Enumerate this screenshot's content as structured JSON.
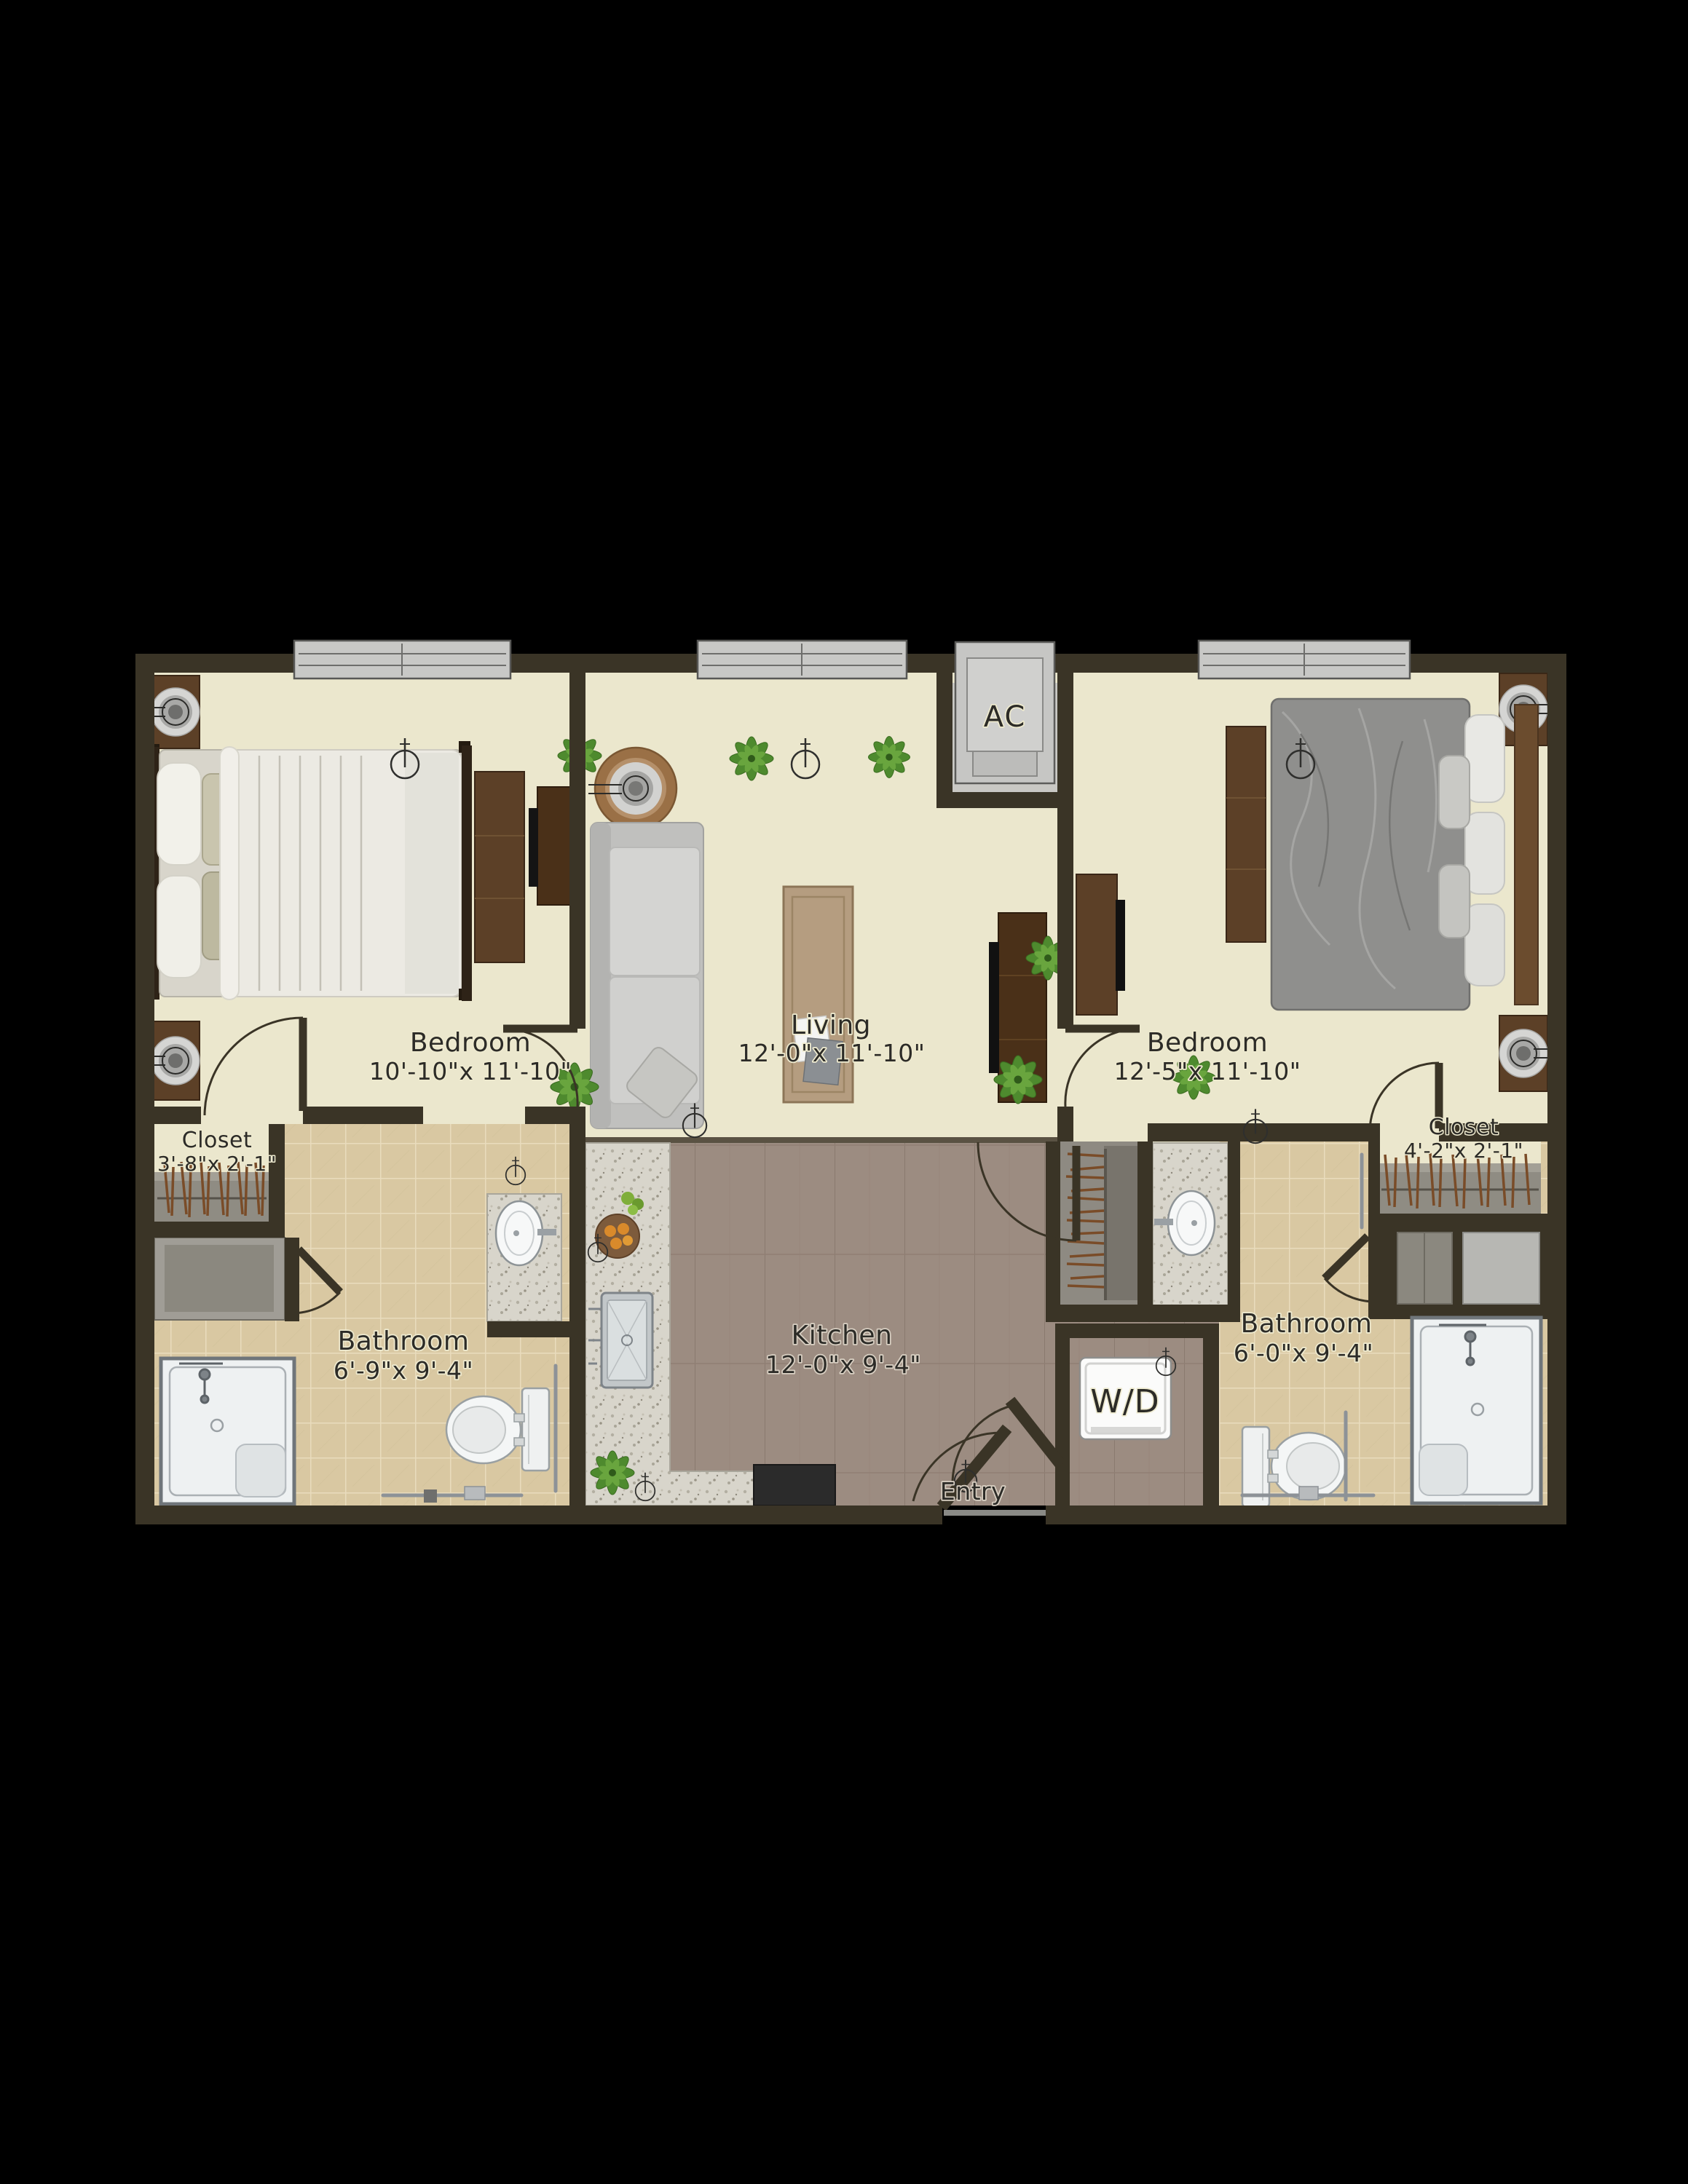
{
  "plan": {
    "title": "Two bedroom two bath apartment floor plan",
    "rooms": [
      {
        "name": "Bedroom",
        "dims": "10'-10\"x 11'-10\""
      },
      {
        "name": "Living",
        "dims": "12'-0\"x 11'-10\""
      },
      {
        "name": "Bedroom",
        "dims": "12'-5\"x 11'-10\""
      },
      {
        "name": "Closet",
        "dims": "3'-8\"x 2'-1\""
      },
      {
        "name": "Closet",
        "dims": "4'-2\"x 2'-1\""
      },
      {
        "name": "Bathroom",
        "dims": "6'-9\"x 9'-4\""
      },
      {
        "name": "Kitchen",
        "dims": "12'-0\"x 9'-4\""
      },
      {
        "name": "Bathroom",
        "dims": "6'-0\"x 9'-4\""
      }
    ],
    "fixture_labels": {
      "ac": "AC",
      "washer_dryer": "W/D",
      "entry": "Entry"
    },
    "colors": {
      "background": "#000000",
      "wall": "#3a3426",
      "floor_cream": "#ebe7cd",
      "floor_tile": "#d9c8a2",
      "floor_wood": "#9c8c81",
      "counter_granite": "#d8d5cb",
      "fixture_white": "#f2f4f4",
      "window_gray": "#c8c8c6",
      "plant_green": "#4e8a2e",
      "closet_gray": "#8f8c83",
      "hanger_brown": "#7a4c28"
    }
  }
}
